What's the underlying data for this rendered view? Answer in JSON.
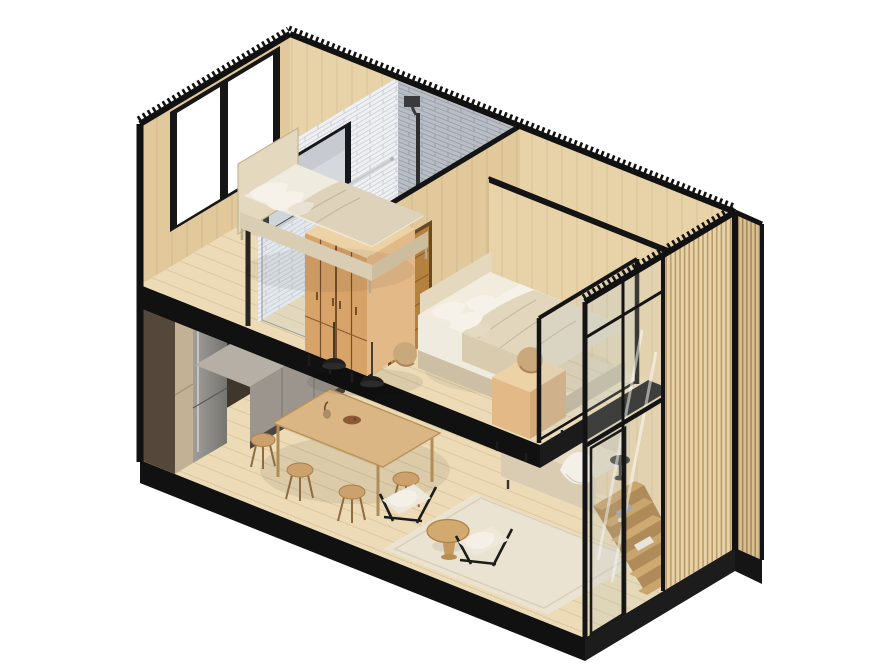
{
  "scene": {
    "type": "isometric-architectural-cutaway",
    "subject": "two-storey tiny house / cabin apartment, section view",
    "upper_floor_objects": [
      "single bed with pillows",
      "black framed window",
      "bathroom with subway tile walls",
      "rain shower head",
      "chrome shower bar",
      "glass shower screen",
      "interior window to bathroom",
      "wooden bathroom door",
      "double oak wardrobe",
      "double bed with beige bedding",
      "wooden bedside cube with sphere lamp",
      "tan floor ball",
      "glass mezzanine railing"
    ],
    "ground_floor_objects": [
      "tall fridge unit",
      "pantry cabinet",
      "grey kitchen counter with sink and black faucet",
      "dark backsplash",
      "wooden dining table",
      "five wooden stools",
      "two black dome pendant lamps",
      "cream rug",
      "two lounge chairs with sheepskin throws",
      "round wooden coffee table",
      "beige sofa with throw blanket",
      "black round side table",
      "wooden winder staircase with folded towels",
      "sliding glass facade",
      "vertical wood slat wall"
    ],
    "structure": [
      "black corrugated roof edge",
      "black steel frame",
      "black base platform",
      "wood plank floors",
      "wood panel walls"
    ]
  },
  "colors": {
    "bg": "#ffffff",
    "black": "#111111",
    "steel": "#1a1a1a",
    "floor": "#ecdbb6",
    "wallWood": "#e8d3a9",
    "wallWoodShade": "#e1c99c",
    "darkWallGround": "#3f372c",
    "tileLight": "#eef0f3",
    "tileLine": "#c6cad0",
    "tileDark": "#b9bec6",
    "tileDarkLine": "#959ba4",
    "oak": "#d7a368",
    "oakSide": "#e3b988",
    "oakTop": "#edd2a6",
    "oakSeam": "#7a4e26",
    "doorWood": "#b5813f",
    "counter": "#9b958e",
    "counterTop": "#b6afa5",
    "sinkDark": "#3a3835",
    "backsplash": "#332d26",
    "fridge": "#92908c",
    "fridgeDark": "#6f6d68",
    "pantry": "#c2b194",
    "tableWood": "#d9b684",
    "stoolWood": "#cda16b",
    "woodEdge": "#a9814c",
    "legWood": "#8f6b40",
    "pendant": "#1d1d1d",
    "rug": "#ebe3d1",
    "rugEdge": "#d9cfba",
    "sofa": "#d9ccb3",
    "sofaLight": "#e6dcc6",
    "cushion": "#efe9db",
    "throw": "#f4f0e7",
    "blanket": "#b7b2aa",
    "bedFrame": "#d9cdb4",
    "mattress": "#f0ebdf",
    "duvet": "#ded3ba",
    "pillow": "#f6f2e9",
    "headboard": "#e4d8be",
    "duvet2": "#e2d7bd",
    "drape": "#d8cbae",
    "platformWood": "#cdbfa4",
    "platformWoodDark": "#c2b296",
    "stair": "#c99a58",
    "stairSide": "#a87a3e",
    "slat": "#e7d3a7",
    "slatShade": "#bb9a6a",
    "slatDark": "#d9c090",
    "finShade": "#a3855c",
    "glassTint": "rgba(205,210,200,0.20)",
    "railGlass": "rgba(190,205,215,0.22)",
    "chrome": "#c6cacf",
    "ball": "#c9a97c",
    "shadow": "rgba(0,0,0,0.14)",
    "underSlab": "rgba(40,28,12,0.25)"
  }
}
